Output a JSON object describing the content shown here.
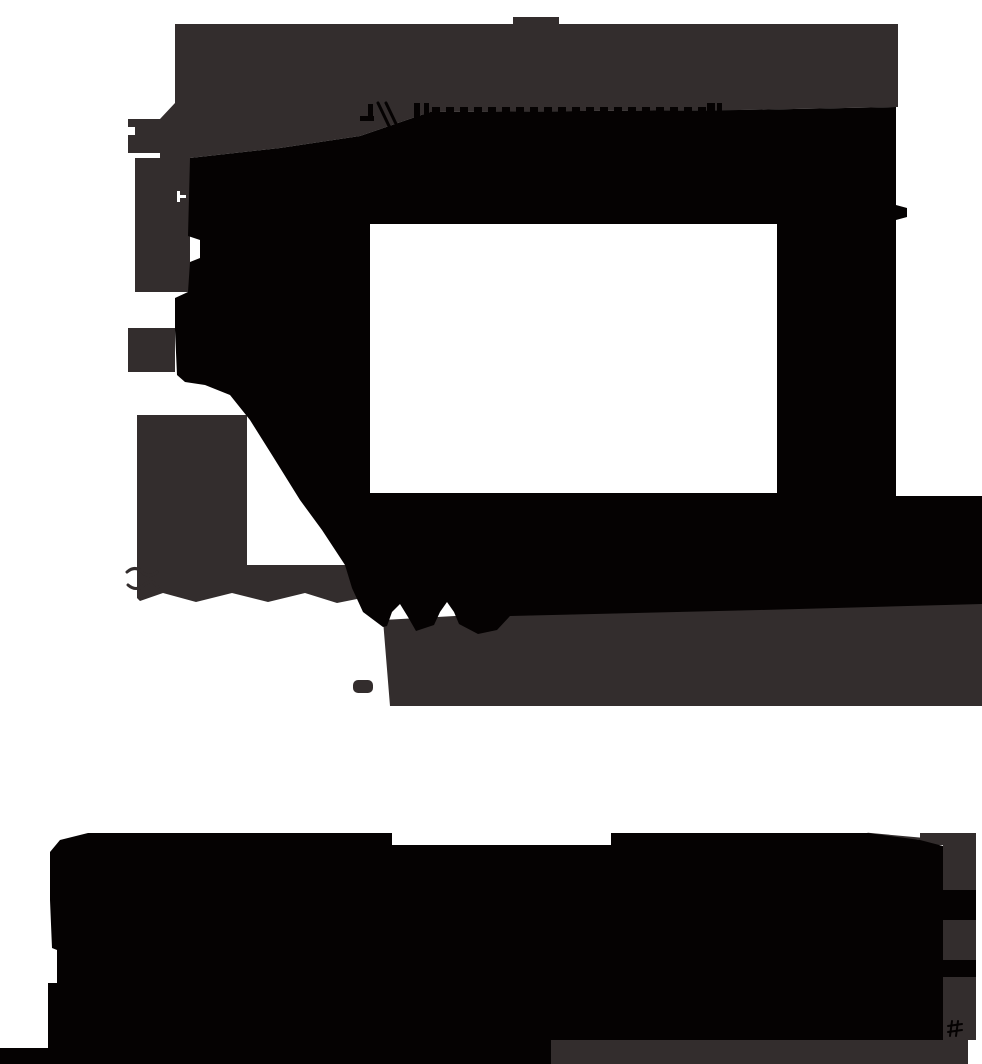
{
  "canvas": {
    "width": 982,
    "height": 1064,
    "background": "#ffffff"
  },
  "palette": {
    "dark_gray": "#332d2d",
    "black": "#050202",
    "white": "#ffffff"
  },
  "shapes": [
    {
      "name": "top-nub",
      "type": "rect",
      "x": 513,
      "y": 17,
      "w": 46,
      "h": 7,
      "fill": "dark_gray"
    },
    {
      "name": "cloud-gray-frame",
      "type": "polygon",
      "fill": "dark_gray",
      "points": [
        [
          175,
          24
        ],
        [
          898,
          24
        ],
        [
          898,
          107
        ],
        [
          740,
          110
        ],
        [
          430,
          112
        ],
        [
          360,
          136
        ],
        [
          280,
          148
        ],
        [
          190,
          158
        ],
        [
          160,
          158
        ],
        [
          160,
          119
        ],
        [
          175,
          103
        ]
      ]
    },
    {
      "name": "cloud-left-tab-upper",
      "type": "rect",
      "x": 128,
      "y": 119,
      "w": 47,
      "h": 8,
      "fill": "dark_gray"
    },
    {
      "name": "cloud-left-tab-mid",
      "type": "rect",
      "x": 135,
      "y": 127,
      "w": 25,
      "h": 8,
      "fill": "dark_gray"
    },
    {
      "name": "cloud-left-tab-lower",
      "type": "rect",
      "x": 128,
      "y": 135,
      "w": 47,
      "h": 18,
      "fill": "dark_gray"
    },
    {
      "name": "cloud-left-column",
      "type": "rect",
      "x": 135,
      "y": 158,
      "w": 55,
      "h": 134,
      "fill": "dark_gray"
    },
    {
      "name": "cloud-left-tab-third",
      "type": "rect",
      "x": 128,
      "y": 328,
      "w": 47,
      "h": 44,
      "fill": "dark_gray"
    },
    {
      "name": "cloud-left-arm",
      "type": "polygon",
      "fill": "dark_gray",
      "points": [
        [
          137,
          415
        ],
        [
          247,
          415
        ],
        [
          247,
          565
        ],
        [
          362,
          565
        ],
        [
          362,
          598
        ],
        [
          337,
          603
        ],
        [
          305,
          593
        ],
        [
          268,
          602
        ],
        [
          232,
          593
        ],
        [
          196,
          602
        ],
        [
          163,
          593
        ],
        [
          140,
          601
        ],
        [
          137,
          598
        ]
      ]
    },
    {
      "name": "arm-scribble-upper",
      "type": "path",
      "d": "M127,572 q8,-7 15,0 t15,0",
      "stroke": "dark_gray",
      "stroke_width": 3
    },
    {
      "name": "arm-scribble-lower",
      "type": "path",
      "d": "M128,585 q8,7 16,0 t14,2",
      "stroke": "dark_gray",
      "stroke_width": 3
    },
    {
      "name": "cloud-gray-bottom-band",
      "type": "polygon",
      "fill": "dark_gray",
      "points": [
        [
          383,
          620
        ],
        [
          455,
          616
        ],
        [
          760,
          606
        ],
        [
          982,
          598
        ],
        [
          982,
          706
        ],
        [
          390,
          706
        ]
      ]
    },
    {
      "name": "gray-dash-below-band",
      "type": "rect",
      "x": 353,
      "y": 680,
      "w": 20,
      "h": 13,
      "rx": 5,
      "fill": "dark_gray"
    },
    {
      "name": "cloud-black-interior",
      "type": "polygon",
      "fill": "black",
      "points": [
        [
          190,
          158
        ],
        [
          280,
          148
        ],
        [
          360,
          136
        ],
        [
          430,
          112
        ],
        [
          740,
          110
        ],
        [
          896,
          107
        ],
        [
          896,
          205
        ],
        [
          907,
          208
        ],
        [
          907,
          217
        ],
        [
          896,
          220
        ],
        [
          896,
          496
        ],
        [
          982,
          496
        ],
        [
          982,
          604
        ],
        [
          760,
          610
        ],
        [
          510,
          616
        ],
        [
          497,
          630
        ],
        [
          478,
          634
        ],
        [
          459,
          624
        ],
        [
          454,
          612
        ],
        [
          447,
          602
        ],
        [
          440,
          612
        ],
        [
          434,
          625
        ],
        [
          416,
          631
        ],
        [
          408,
          617
        ],
        [
          400,
          604
        ],
        [
          392,
          612
        ],
        [
          387,
          626
        ],
        [
          383,
          627
        ],
        [
          363,
          612
        ],
        [
          352,
          588
        ],
        [
          345,
          565
        ],
        [
          322,
          530
        ],
        [
          300,
          500
        ],
        [
          272,
          455
        ],
        [
          250,
          420
        ],
        [
          230,
          395
        ],
        [
          205,
          385
        ],
        [
          185,
          382
        ],
        [
          177,
          375
        ],
        [
          175,
          330
        ],
        [
          175,
          298
        ],
        [
          188,
          292
        ],
        [
          190,
          262
        ],
        [
          200,
          258
        ],
        [
          200,
          240
        ],
        [
          188,
          236
        ]
      ]
    },
    {
      "name": "comb-dash-row",
      "type": "dash_row",
      "y": 107,
      "h": 6,
      "x_start": 432,
      "x_end": 706,
      "dash_w": 8,
      "gap": 6,
      "fill": "black"
    },
    {
      "name": "comb-bar-left-a",
      "type": "rect",
      "x": 414,
      "y": 103,
      "w": 6,
      "h": 26,
      "fill": "black"
    },
    {
      "name": "comb-bar-left-b",
      "type": "rect",
      "x": 424,
      "y": 103,
      "w": 5,
      "h": 26,
      "fill": "black"
    },
    {
      "name": "comb-bar-right-a",
      "type": "rect",
      "x": 707,
      "y": 103,
      "w": 8,
      "h": 26,
      "fill": "black"
    },
    {
      "name": "comb-bar-right-b",
      "type": "rect",
      "x": 717,
      "y": 103,
      "w": 5,
      "h": 26,
      "fill": "black"
    },
    {
      "name": "comb-glyph-dash",
      "type": "rect",
      "x": 360,
      "y": 116,
      "w": 14,
      "h": 5,
      "fill": "black"
    },
    {
      "name": "comb-glyph-stem",
      "type": "rect",
      "x": 368,
      "y": 104,
      "w": 5,
      "h": 17,
      "fill": "black"
    },
    {
      "name": "comb-glyph-slash-a",
      "type": "line",
      "x1": 378,
      "y1": 103,
      "x2": 390,
      "y2": 128,
      "stroke": "black",
      "stroke_width": 3
    },
    {
      "name": "comb-glyph-slash-b",
      "type": "line",
      "x1": 386,
      "y1": 103,
      "x2": 398,
      "y2": 128,
      "stroke": "black",
      "stroke_width": 3
    },
    {
      "name": "white-rectangle-hole",
      "type": "rect",
      "x": 370,
      "y": 224,
      "w": 407,
      "h": 269,
      "fill": "white"
    },
    {
      "name": "white-speck-glyph-stem",
      "type": "rect",
      "x": 177,
      "y": 191,
      "w": 3,
      "h": 11,
      "fill": "white"
    },
    {
      "name": "white-speck-glyph-arm",
      "type": "rect",
      "x": 180,
      "y": 195,
      "w": 6,
      "h": 3,
      "fill": "white"
    },
    {
      "name": "mass-top-stroke",
      "type": "line",
      "x1": 868,
      "y1": 834,
      "x2": 922,
      "y2": 839,
      "stroke": "dark_gray",
      "stroke_width": 2.5
    },
    {
      "name": "mass-right-wedge-gray",
      "type": "rect",
      "x": 920,
      "y": 833,
      "w": 56,
      "h": 12,
      "fill": "dark_gray"
    },
    {
      "name": "mass-right-gray-1",
      "type": "rect",
      "x": 943,
      "y": 845,
      "w": 33,
      "h": 45,
      "fill": "dark_gray"
    },
    {
      "name": "mass-right-black-1",
      "type": "rect",
      "x": 943,
      "y": 890,
      "w": 33,
      "h": 30,
      "fill": "black"
    },
    {
      "name": "mass-right-gray-2",
      "type": "rect",
      "x": 943,
      "y": 920,
      "w": 33,
      "h": 40,
      "fill": "dark_gray"
    },
    {
      "name": "mass-right-black-2",
      "type": "rect",
      "x": 943,
      "y": 960,
      "w": 33,
      "h": 17,
      "fill": "black"
    },
    {
      "name": "mass-right-gray-3",
      "type": "rect",
      "x": 943,
      "y": 977,
      "w": 33,
      "h": 63,
      "fill": "dark_gray"
    },
    {
      "name": "mass-bottom-right-gray",
      "type": "rect",
      "x": 551,
      "y": 1040,
      "w": 417,
      "h": 24,
      "fill": "dark_gray"
    },
    {
      "name": "bottom-black-mass",
      "type": "polygon",
      "fill": "black",
      "points": [
        [
          88,
          833
        ],
        [
          392,
          833
        ],
        [
          392,
          845
        ],
        [
          611,
          845
        ],
        [
          611,
          833
        ],
        [
          868,
          833
        ],
        [
          920,
          840
        ],
        [
          943,
          846
        ],
        [
          943,
          1040
        ],
        [
          551,
          1040
        ],
        [
          551,
          1064
        ],
        [
          0,
          1064
        ],
        [
          0,
          1048
        ],
        [
          48,
          1048
        ],
        [
          48,
          983
        ],
        [
          57,
          983
        ],
        [
          57,
          950
        ],
        [
          52,
          948
        ],
        [
          50,
          900
        ],
        [
          50,
          852
        ],
        [
          60,
          840
        ]
      ]
    },
    {
      "name": "hash-glyph-stroke-1",
      "type": "line",
      "x1": 948,
      "y1": 1026,
      "x2": 962,
      "y2": 1024,
      "stroke": "black",
      "stroke_width": 2
    },
    {
      "name": "hash-glyph-stroke-2",
      "type": "line",
      "x1": 948,
      "y1": 1032,
      "x2": 962,
      "y2": 1030,
      "stroke": "black",
      "stroke_width": 2
    },
    {
      "name": "hash-glyph-stroke-3",
      "type": "line",
      "x1": 952,
      "y1": 1021,
      "x2": 950,
      "y2": 1036,
      "stroke": "black",
      "stroke_width": 2
    },
    {
      "name": "hash-glyph-stroke-4",
      "type": "line",
      "x1": 958,
      "y1": 1021,
      "x2": 956,
      "y2": 1036,
      "stroke": "black",
      "stroke_width": 2
    }
  ]
}
